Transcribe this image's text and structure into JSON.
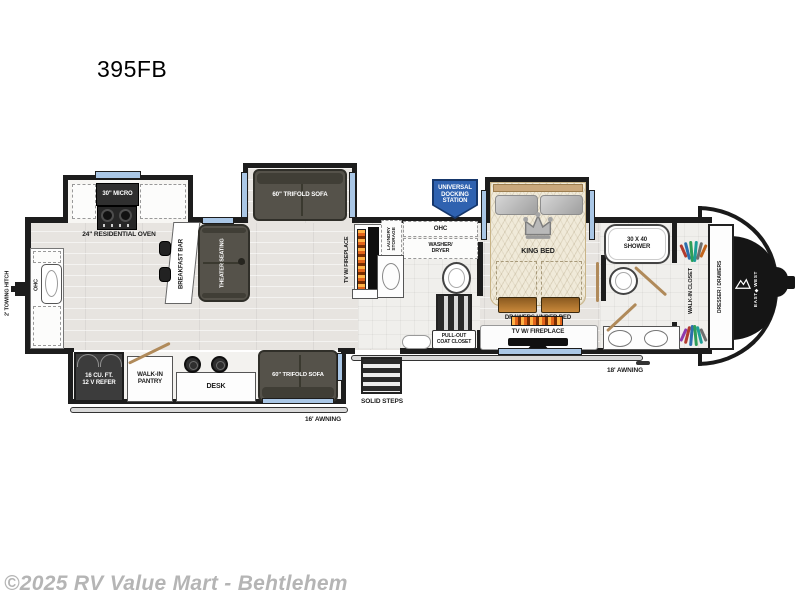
{
  "title": "395FB",
  "watermark": "©2025 RV Value Mart - Behtlehem",
  "colors": {
    "wall": "#1d1d1d",
    "window_blue": "#aac7e6",
    "badge_blue": "#2f62b0",
    "sofa_dark": "#55524a",
    "floor": "#e7e4e0",
    "drawer_wood": "#c9893b",
    "door_tan": "#b08a5a",
    "watermark_gray": "#b5b5b5"
  },
  "floorplan": {
    "exterior": {
      "towing_hitch": "2' TOWING HITCH",
      "awning_left": "16' AWNING",
      "awning_right": "18' AWNING",
      "solid_steps": "SOLID STEPS",
      "brand": "EAST◆WEST",
      "docking": {
        "l1": "UNIVERSAL",
        "l2": "DOCKING",
        "l3": "STATION"
      }
    },
    "kitchen": {
      "ohc": "OHC",
      "micro": "30\" MICRO",
      "oven": "24\" RESIDENTIAL OVEN",
      "breakfast_bar": "BREAKFAST BAR",
      "fridge": {
        "l1": "16 CU. FT.",
        "l2": "12 V REFER"
      },
      "pantry": {
        "l1": "WALK-IN",
        "l2": "PANTRY"
      },
      "desk": "DESK"
    },
    "living": {
      "sofa_top": "60\" TRIFOLD SOFA",
      "sofa_bottom": "60\" TRIFOLD SOFA",
      "theater": "THEATER SEATING",
      "tv": "TV W/ FIREPLACE"
    },
    "bath_mid": {
      "laundry": {
        "l1": "LAUNDRY",
        "l2": "STORAGE"
      },
      "ohc": "OHC",
      "washer": {
        "l1": "WASHER/",
        "l2": "DRYER"
      },
      "coat": {
        "l1": "PULL-OUT",
        "l2": "COAT CLOSET"
      }
    },
    "bedroom": {
      "king_bed": "KING BED",
      "drawers": "DRAWERS UNDER BED",
      "tv": "TV W/ FIREPLACE"
    },
    "bath_front": {
      "shower": {
        "l1": "30 X 40",
        "l2": "SHOWER"
      },
      "closet": "WALK-IN CLOSET",
      "dresser": "DRESSER / DRAWERS"
    }
  }
}
